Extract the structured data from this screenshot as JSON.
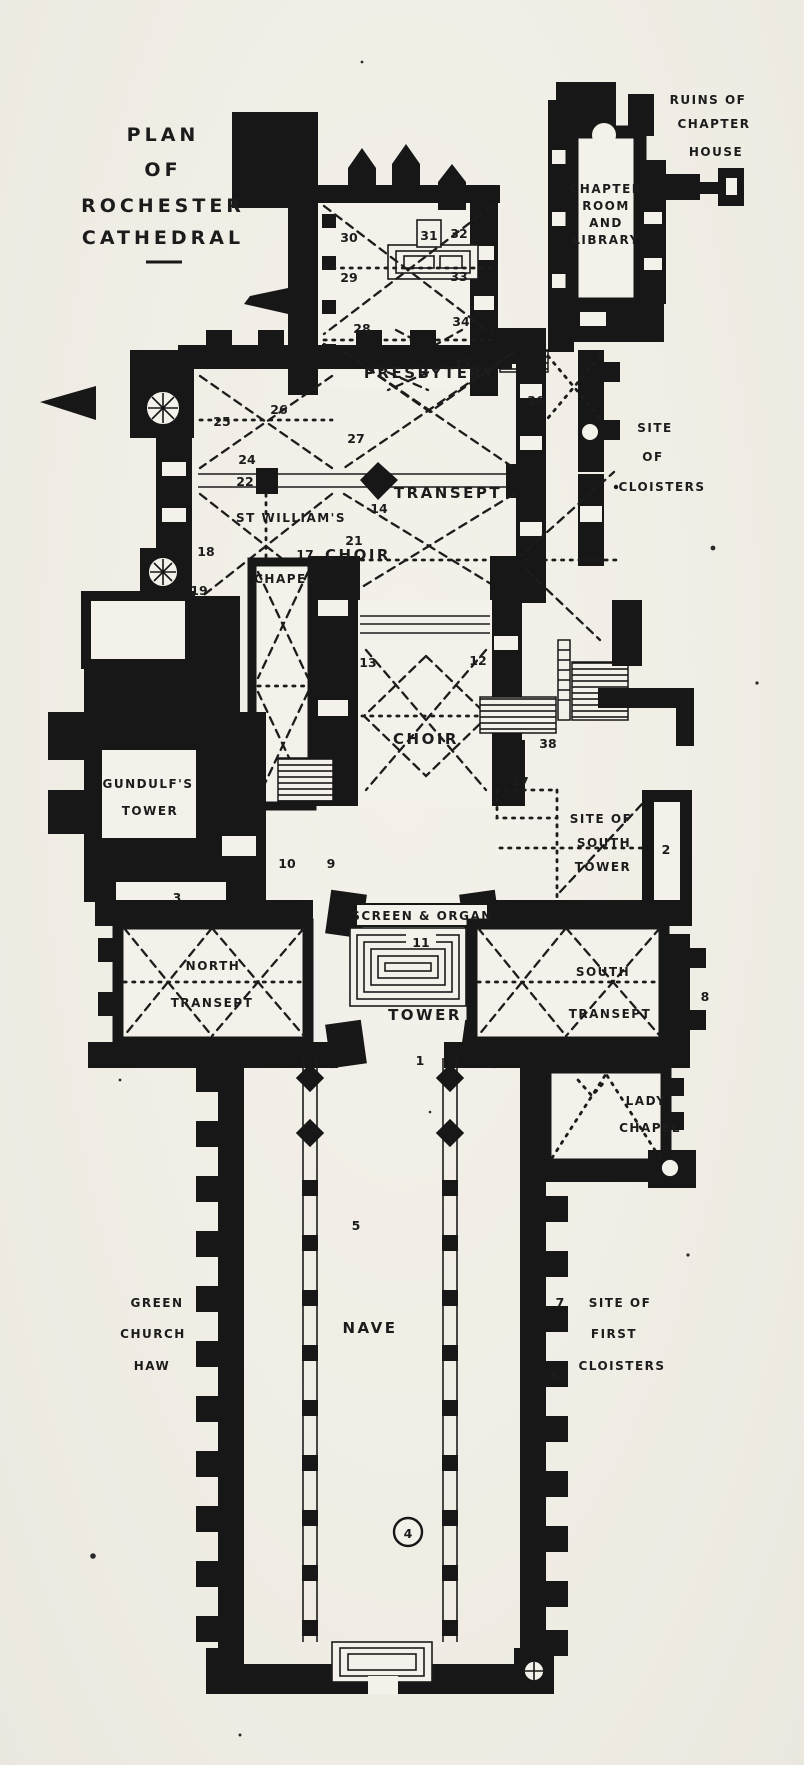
{
  "title": {
    "lines": [
      "PLAN",
      "OF",
      "ROCHESTER",
      "CATHEDRAL"
    ]
  },
  "areas": {
    "ruins_of_chapter_house": {
      "lines": [
        "RUINS OF",
        "CHAPTER",
        "HOUSE"
      ]
    },
    "chapter_room_and_library": {
      "lines": [
        "CHAPTER",
        "ROOM",
        "AND",
        "LIBRARY"
      ]
    },
    "presbytery": {
      "label": "PRESBYTERY"
    },
    "site_of_cloisters": {
      "lines": [
        "SITE",
        "OF",
        "CLOISTERS"
      ]
    },
    "st_williams_chapel": {
      "lines": [
        "ST WILLIAM'S",
        "CHAPEL"
      ]
    },
    "choir_transept": {
      "lines": [
        "CHOIR",
        "TRANSEPT"
      ]
    },
    "choir": {
      "label": "CHOIR"
    },
    "gundulfs_tower": {
      "lines": [
        "GUNDULF'S",
        "TOWER"
      ]
    },
    "site_of_south_tower": {
      "lines": [
        "SITE OF",
        "SOUTH",
        "TOWER"
      ]
    },
    "screen_and_organ": {
      "label": "SCREEN & ORGAN"
    },
    "north_transept": {
      "lines": [
        "NORTH",
        "TRANSEPT"
      ]
    },
    "crossing_tower": {
      "label": "TOWER"
    },
    "south_transept": {
      "lines": [
        "SOUTH",
        "TRANSEPT"
      ]
    },
    "lady_chapel": {
      "lines": [
        "LADY",
        "CHAPEL"
      ]
    },
    "green_church_haw": {
      "lines": [
        "GREEN",
        "CHURCH",
        "HAW"
      ]
    },
    "nave": {
      "label": "NAVE"
    },
    "site_of_first_cloisters": {
      "lines": [
        "SITE OF",
        "FIRST",
        "CLOISTERS"
      ]
    }
  },
  "markers": {
    "n1": "1",
    "n2": "2",
    "n3": "3",
    "n4": "4",
    "n5": "5",
    "n6": "6",
    "n7": "7",
    "n8": "8",
    "n9": "9",
    "n10": "10",
    "n11": "11",
    "n12": "12",
    "n13": "13",
    "n14": "14",
    "n17": "17",
    "n18": "18",
    "n19": "19",
    "n21": "21",
    "n22": "22",
    "n24": "24",
    "n25": "25",
    "n26": "26",
    "n27": "27",
    "n28": "28",
    "n29": "29",
    "n30": "30",
    "n31": "31",
    "n32": "32",
    "n33": "33",
    "n34": "34",
    "n35": "35",
    "n36": "36",
    "n37": "37",
    "n38": "38"
  },
  "colors": {
    "paper": "#f1eee7",
    "ink": "#171717"
  }
}
